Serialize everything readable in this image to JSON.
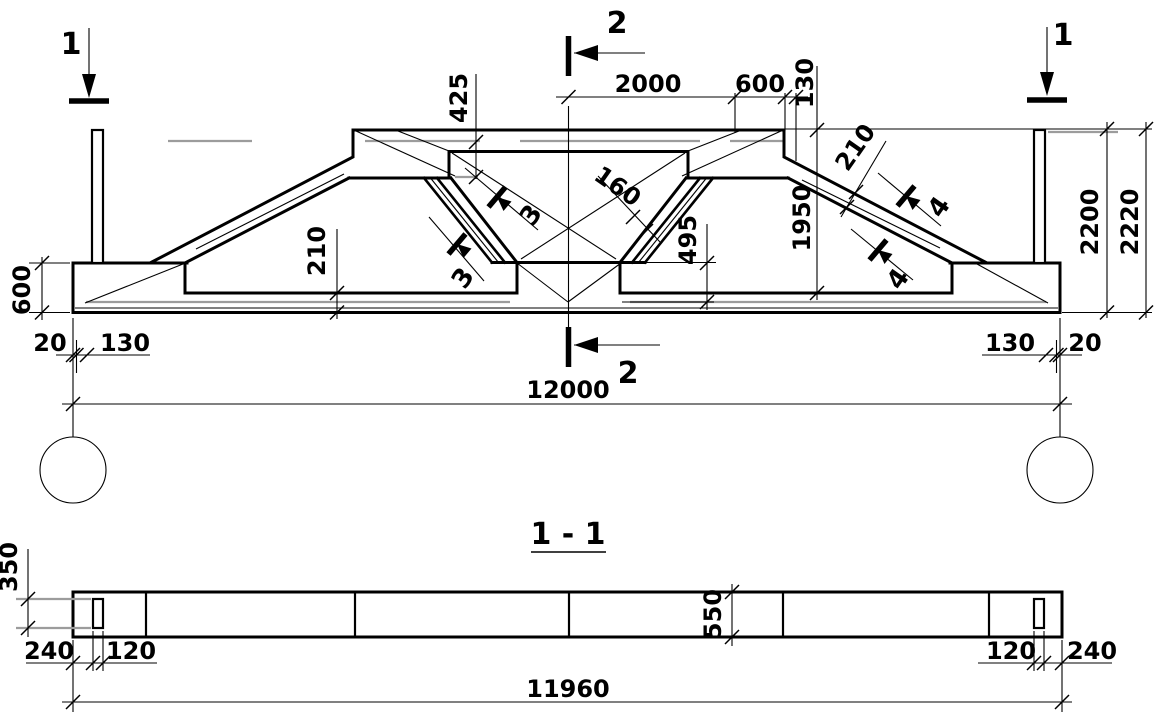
{
  "colors": {
    "ink": "#000000",
    "gray": "#9c9c9c",
    "background": "#ffffff"
  },
  "elevation": {
    "cuts": {
      "c1_left": "1",
      "c1_right": "1",
      "c2_top": "2",
      "c2_bottom": "2",
      "c3_upper": "3",
      "c3_lower": "3",
      "c4_upper": "4",
      "c4_lower": "4"
    },
    "dims": {
      "d425": "425",
      "d2000": "2000",
      "d600_top": "600",
      "d130_top": "130",
      "d160": "160",
      "d1950": "1950",
      "d210_chord": "210",
      "d495": "495",
      "d210_bottom": "210",
      "d600_left": "600",
      "d20_left": "20",
      "d130_left": "130",
      "d130_right": "130",
      "d20_right": "20",
      "d12000": "12000",
      "d2200": "2200",
      "d2220": "2220"
    }
  },
  "section": {
    "title": "1 - 1",
    "dims": {
      "d350": "350",
      "d240_left": "240",
      "d120_left": "120",
      "d550": "550",
      "d120_right": "120",
      "d240_right": "240",
      "d11960": "11960"
    }
  }
}
